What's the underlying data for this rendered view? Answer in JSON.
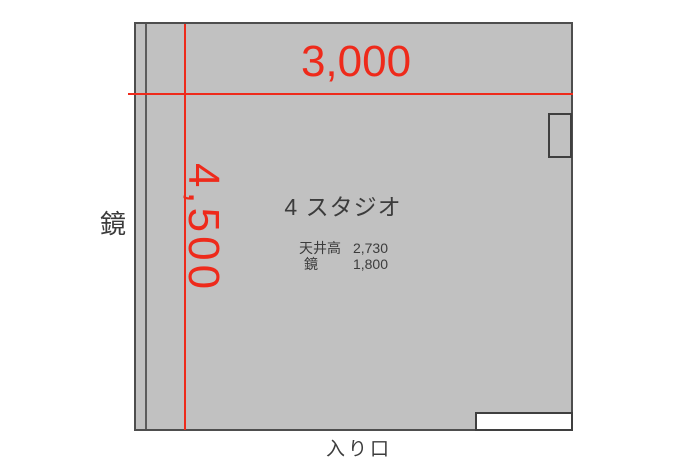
{
  "floorplan": {
    "title": "4 スタジオ",
    "dimensions": {
      "width": "3,000",
      "depth": "4,500"
    },
    "annotations": {
      "mirror_wall": "鏡",
      "entrance": "入り口"
    },
    "notes": [
      {
        "label": "天井高",
        "value": "2,730"
      },
      {
        "label": "鏡",
        "value": "1,800"
      }
    ],
    "colors": {
      "dimension_red": "#ee2a1b",
      "room_fill": "#c1c1c1",
      "wall": "#4e4e4e",
      "text": "#3c3c3c"
    }
  }
}
